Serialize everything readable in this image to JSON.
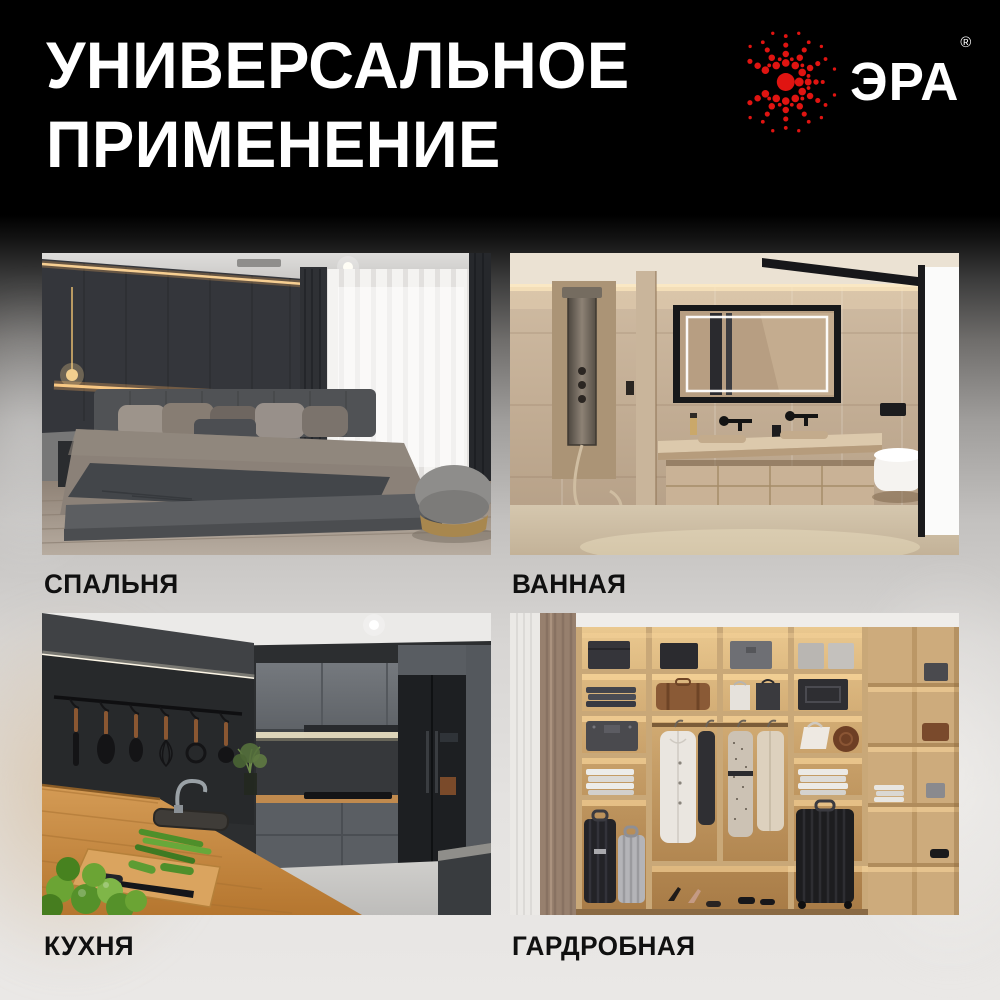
{
  "header": {
    "title_line1": "УНИВЕРСАЛЬНОЕ",
    "title_line2": "ПРИМЕНЕНИЕ",
    "brand": {
      "name": "ЭРА",
      "registered_mark": "®",
      "logo_icon": "red-dot-sunburst-icon",
      "logo_color": "#e01411"
    }
  },
  "gallery": {
    "items": [
      {
        "id": "bedroom",
        "label": "СПАЛЬНЯ"
      },
      {
        "id": "bathroom",
        "label": "ВАННАЯ"
      },
      {
        "id": "kitchen",
        "label": "КУХНЯ"
      },
      {
        "id": "wardrobe",
        "label": "ГАРДРОБНАЯ"
      }
    ]
  },
  "colors": {
    "title_text": "#ffffff",
    "label_text": "#101010",
    "header_background": "#000000"
  }
}
